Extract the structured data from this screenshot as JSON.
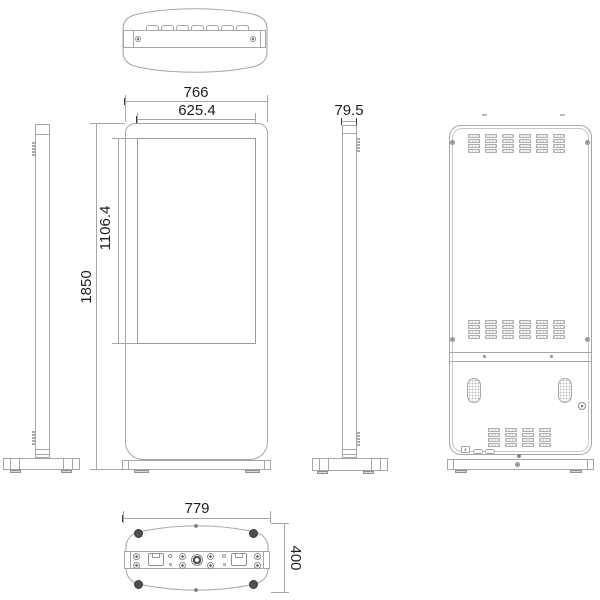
{
  "drawing": {
    "line_color": "#a6a6a6",
    "text_color": "#1d1d1d",
    "dimensions": {
      "overall_width": "766",
      "screen_width": "625.4",
      "overall_height": "1850",
      "screen_height": "1106.4",
      "depth": "79.5",
      "base_width": "779",
      "base_depth": "400"
    }
  }
}
